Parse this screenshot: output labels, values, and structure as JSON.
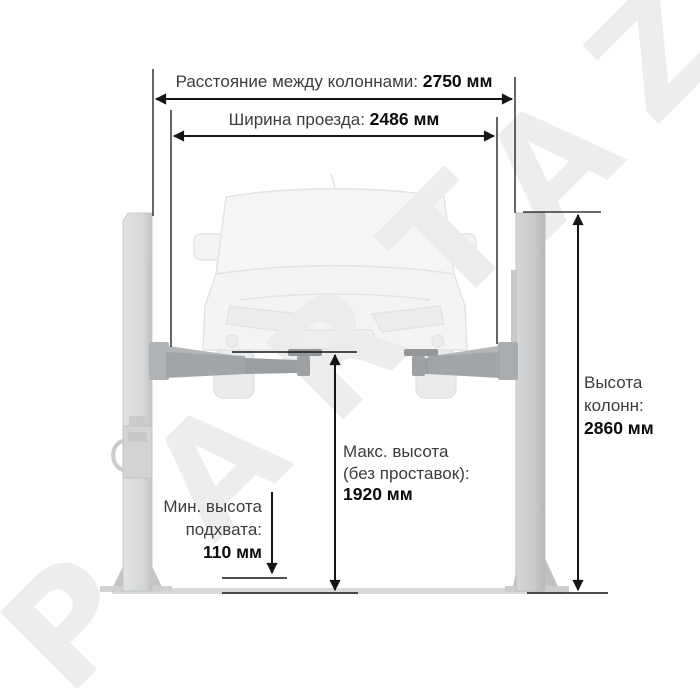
{
  "watermark": {
    "text": "PARTAZ",
    "letters": [
      "P",
      "A",
      "R",
      "T",
      "A",
      "Z"
    ],
    "color": "#ebebeb"
  },
  "annotations": {
    "column_distance": {
      "label": "Расстояние между колоннами:",
      "value": "2750 мм"
    },
    "drive_width": {
      "label": "Ширина проезда:",
      "value": "2486 мм"
    },
    "column_height": {
      "line1": "Высота",
      "line2": "колонн:",
      "value": "2860 мм"
    },
    "max_height": {
      "line1": "Макс. высота",
      "line2": "(без проставок):",
      "value": "1920 мм"
    },
    "min_pickup_height": {
      "line1": "Мин. высота",
      "line2": "подхвата:",
      "value": "110 мм"
    }
  },
  "colors": {
    "dimension_line": "#1a1a1a",
    "label_text": "#3c3c3c",
    "value_text": "#0c0c0c",
    "left_column_fill": "#d6d8d9",
    "right_column_fill": "#c9cbcc",
    "arm_fill": "#a2a5a8",
    "floor_fill": "#d8d9da",
    "car_fill": "#f4f4f5",
    "car_outline": "#e2e3e4",
    "watermark": "#ebebeb",
    "background": "#ffffff"
  }
}
